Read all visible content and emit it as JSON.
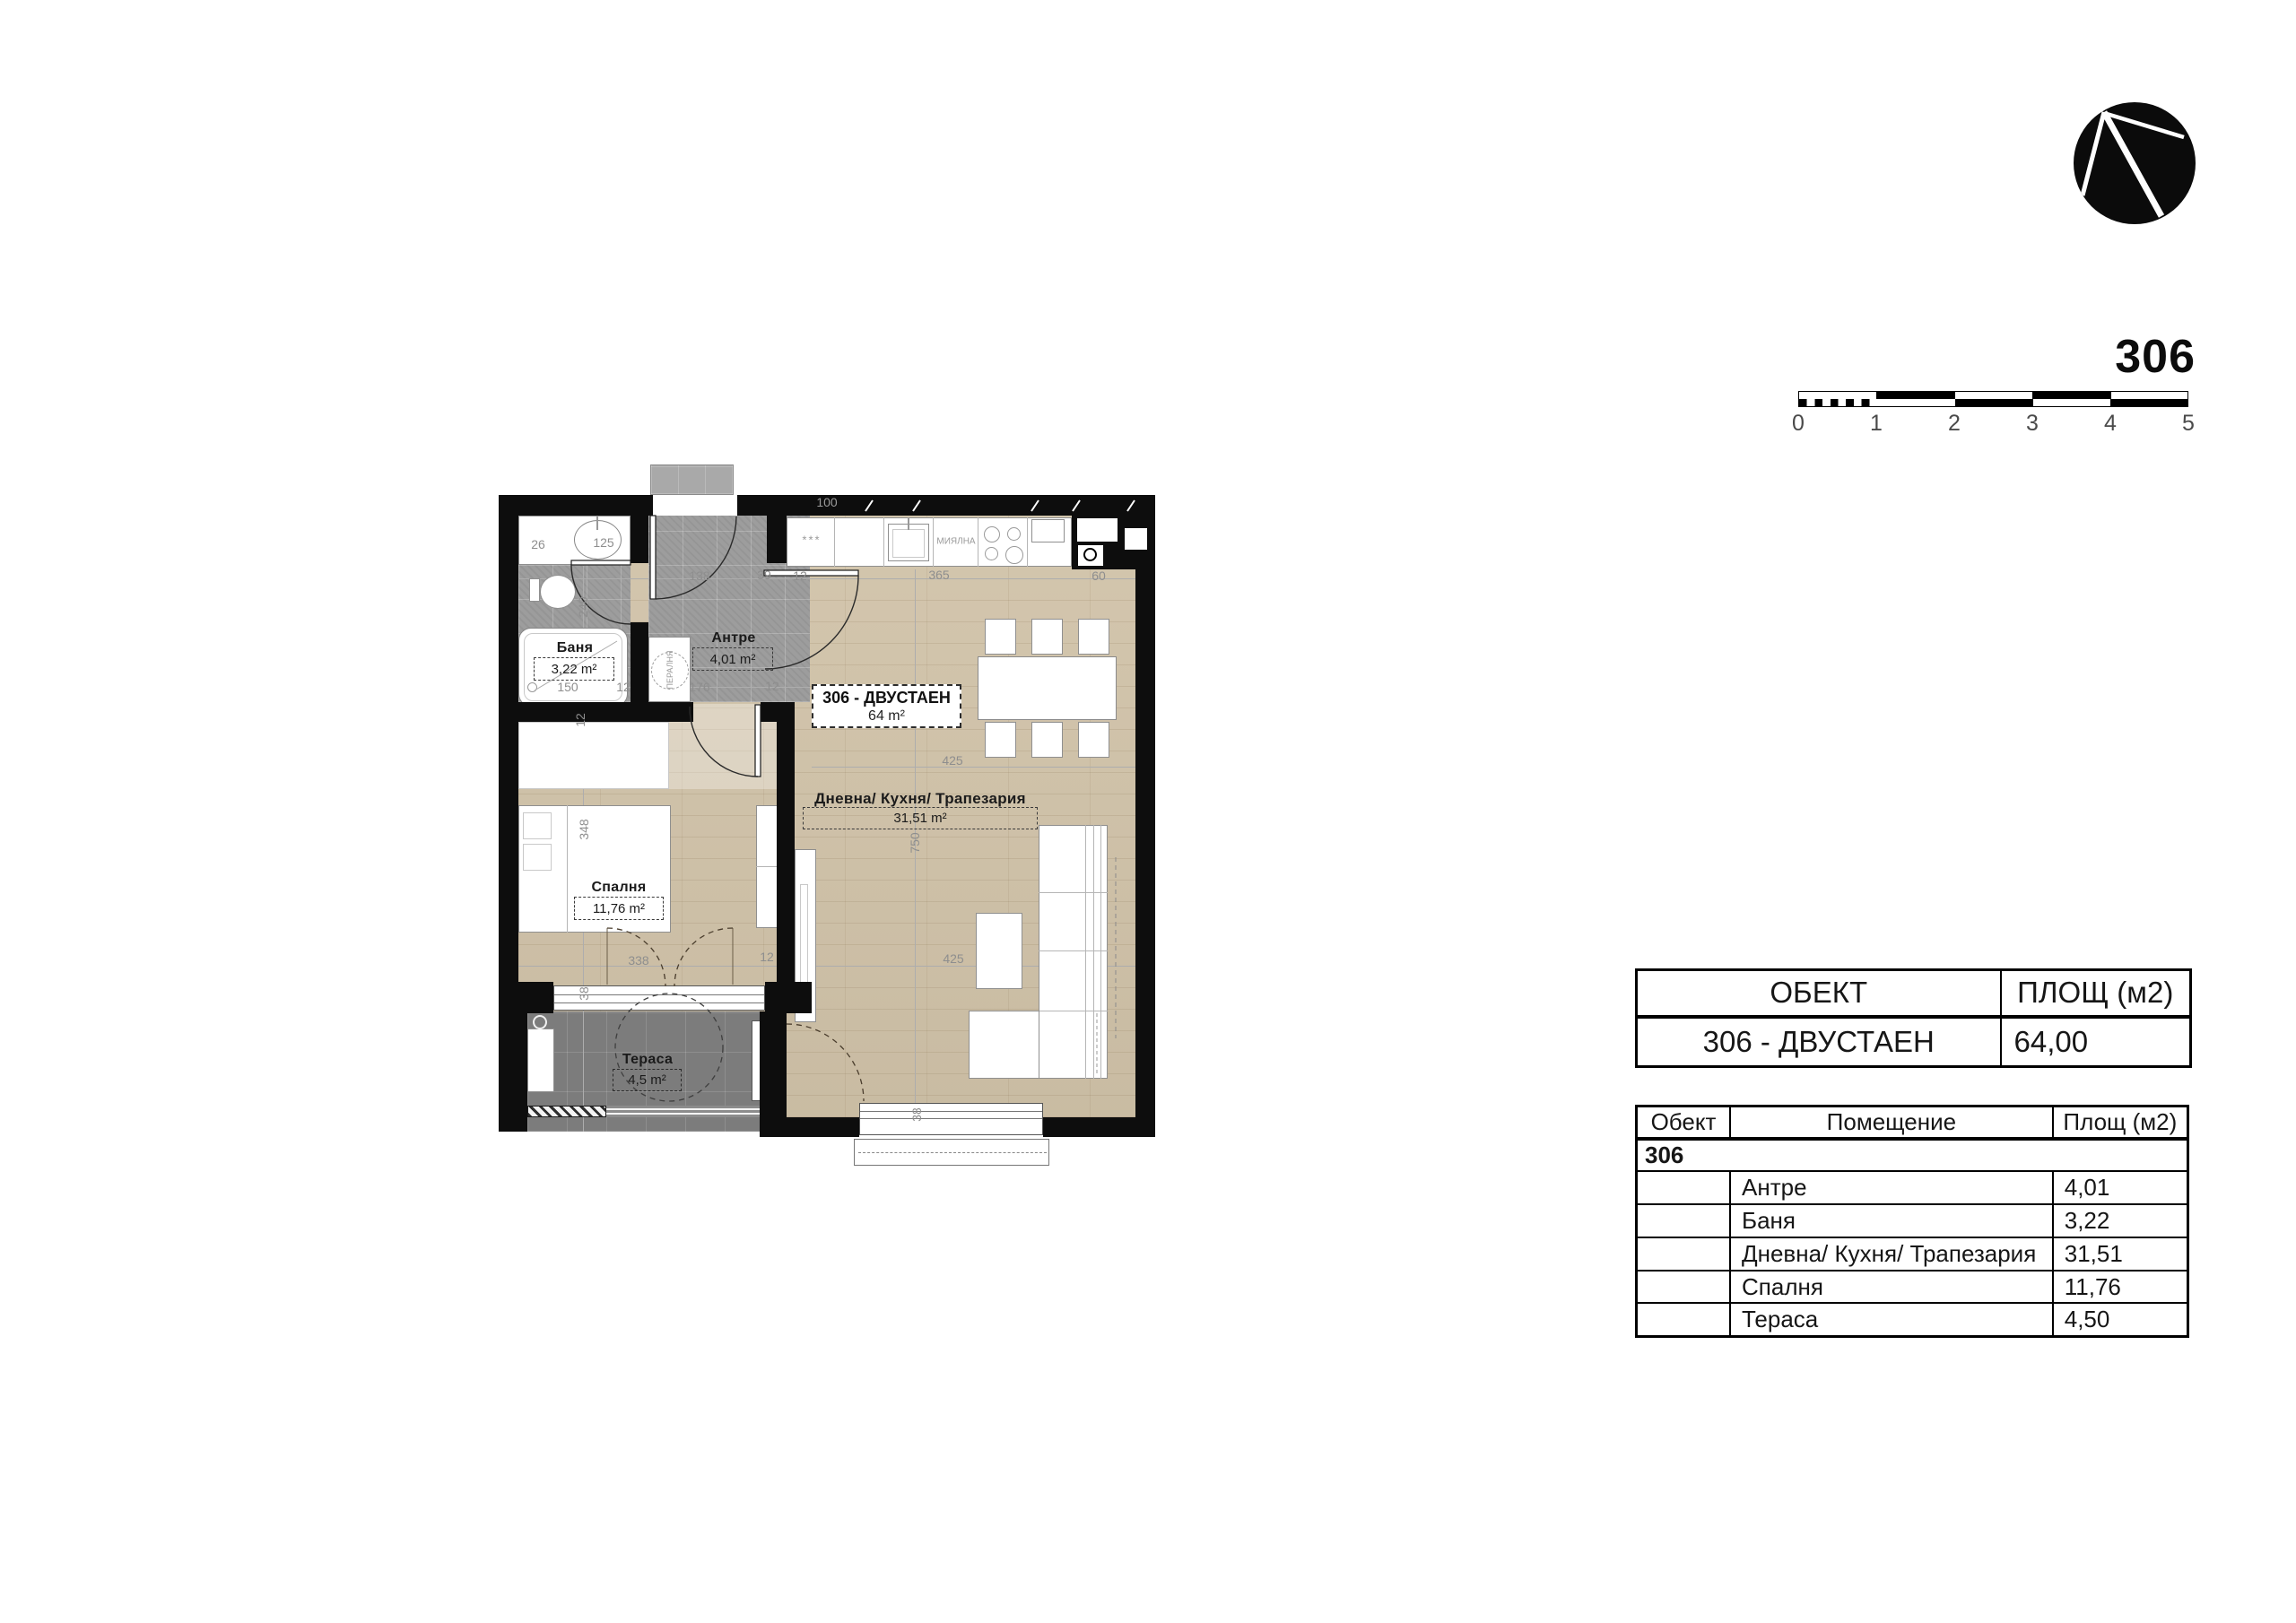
{
  "page": {
    "apartment_number": "306"
  },
  "scale_bar": {
    "labels": [
      "0",
      "1",
      "2",
      "3",
      "4",
      "5"
    ]
  },
  "summary_table": {
    "col_object": "ОБЕКТ",
    "col_area": "ПЛОЩ (м2)",
    "row_object": "306 - ДВУСТАЕН",
    "row_area": "64,00"
  },
  "rooms_table": {
    "col_object": "Обект",
    "col_room": "Помещение",
    "col_area": "Площ (м2)",
    "group": "306",
    "rows": [
      {
        "room": "Антре",
        "area": "4,01"
      },
      {
        "room": "Баня",
        "area": "3,22"
      },
      {
        "room": "Дневна/ Кухня/ Трапезария",
        "area": "31,51"
      },
      {
        "room": "Спалня",
        "area": "11,76"
      },
      {
        "room": "Тераса",
        "area": "4,50"
      }
    ]
  },
  "plan": {
    "unit_label": {
      "line1": "306 - ДВУСТАЕН",
      "line2": "64 m²"
    },
    "rooms": {
      "bathroom": {
        "name": "Баня",
        "area": "3,22 m²"
      },
      "hall": {
        "name": "Антре",
        "area": "4,01 m²"
      },
      "living": {
        "name": "Дневна/ Кухня/ Трапезария",
        "area": "31,51 m²"
      },
      "bedroom": {
        "name": "Спалня",
        "area": "11,76 m²"
      },
      "terrace": {
        "name": "Тераса",
        "area": "4,5 m²"
      }
    },
    "appliances": {
      "dishwasher": "МИЯЛНА",
      "washer": "ПЕРАЛНЯ",
      "fridge_marks": "***"
    },
    "dims": [
      "26",
      "125",
      "240",
      "138",
      "39",
      "12",
      "100",
      "365",
      "60",
      "150",
      "12",
      "176",
      "12",
      "12",
      "348",
      "425",
      "750",
      "338",
      "12",
      "38",
      "425",
      "38"
    ]
  }
}
